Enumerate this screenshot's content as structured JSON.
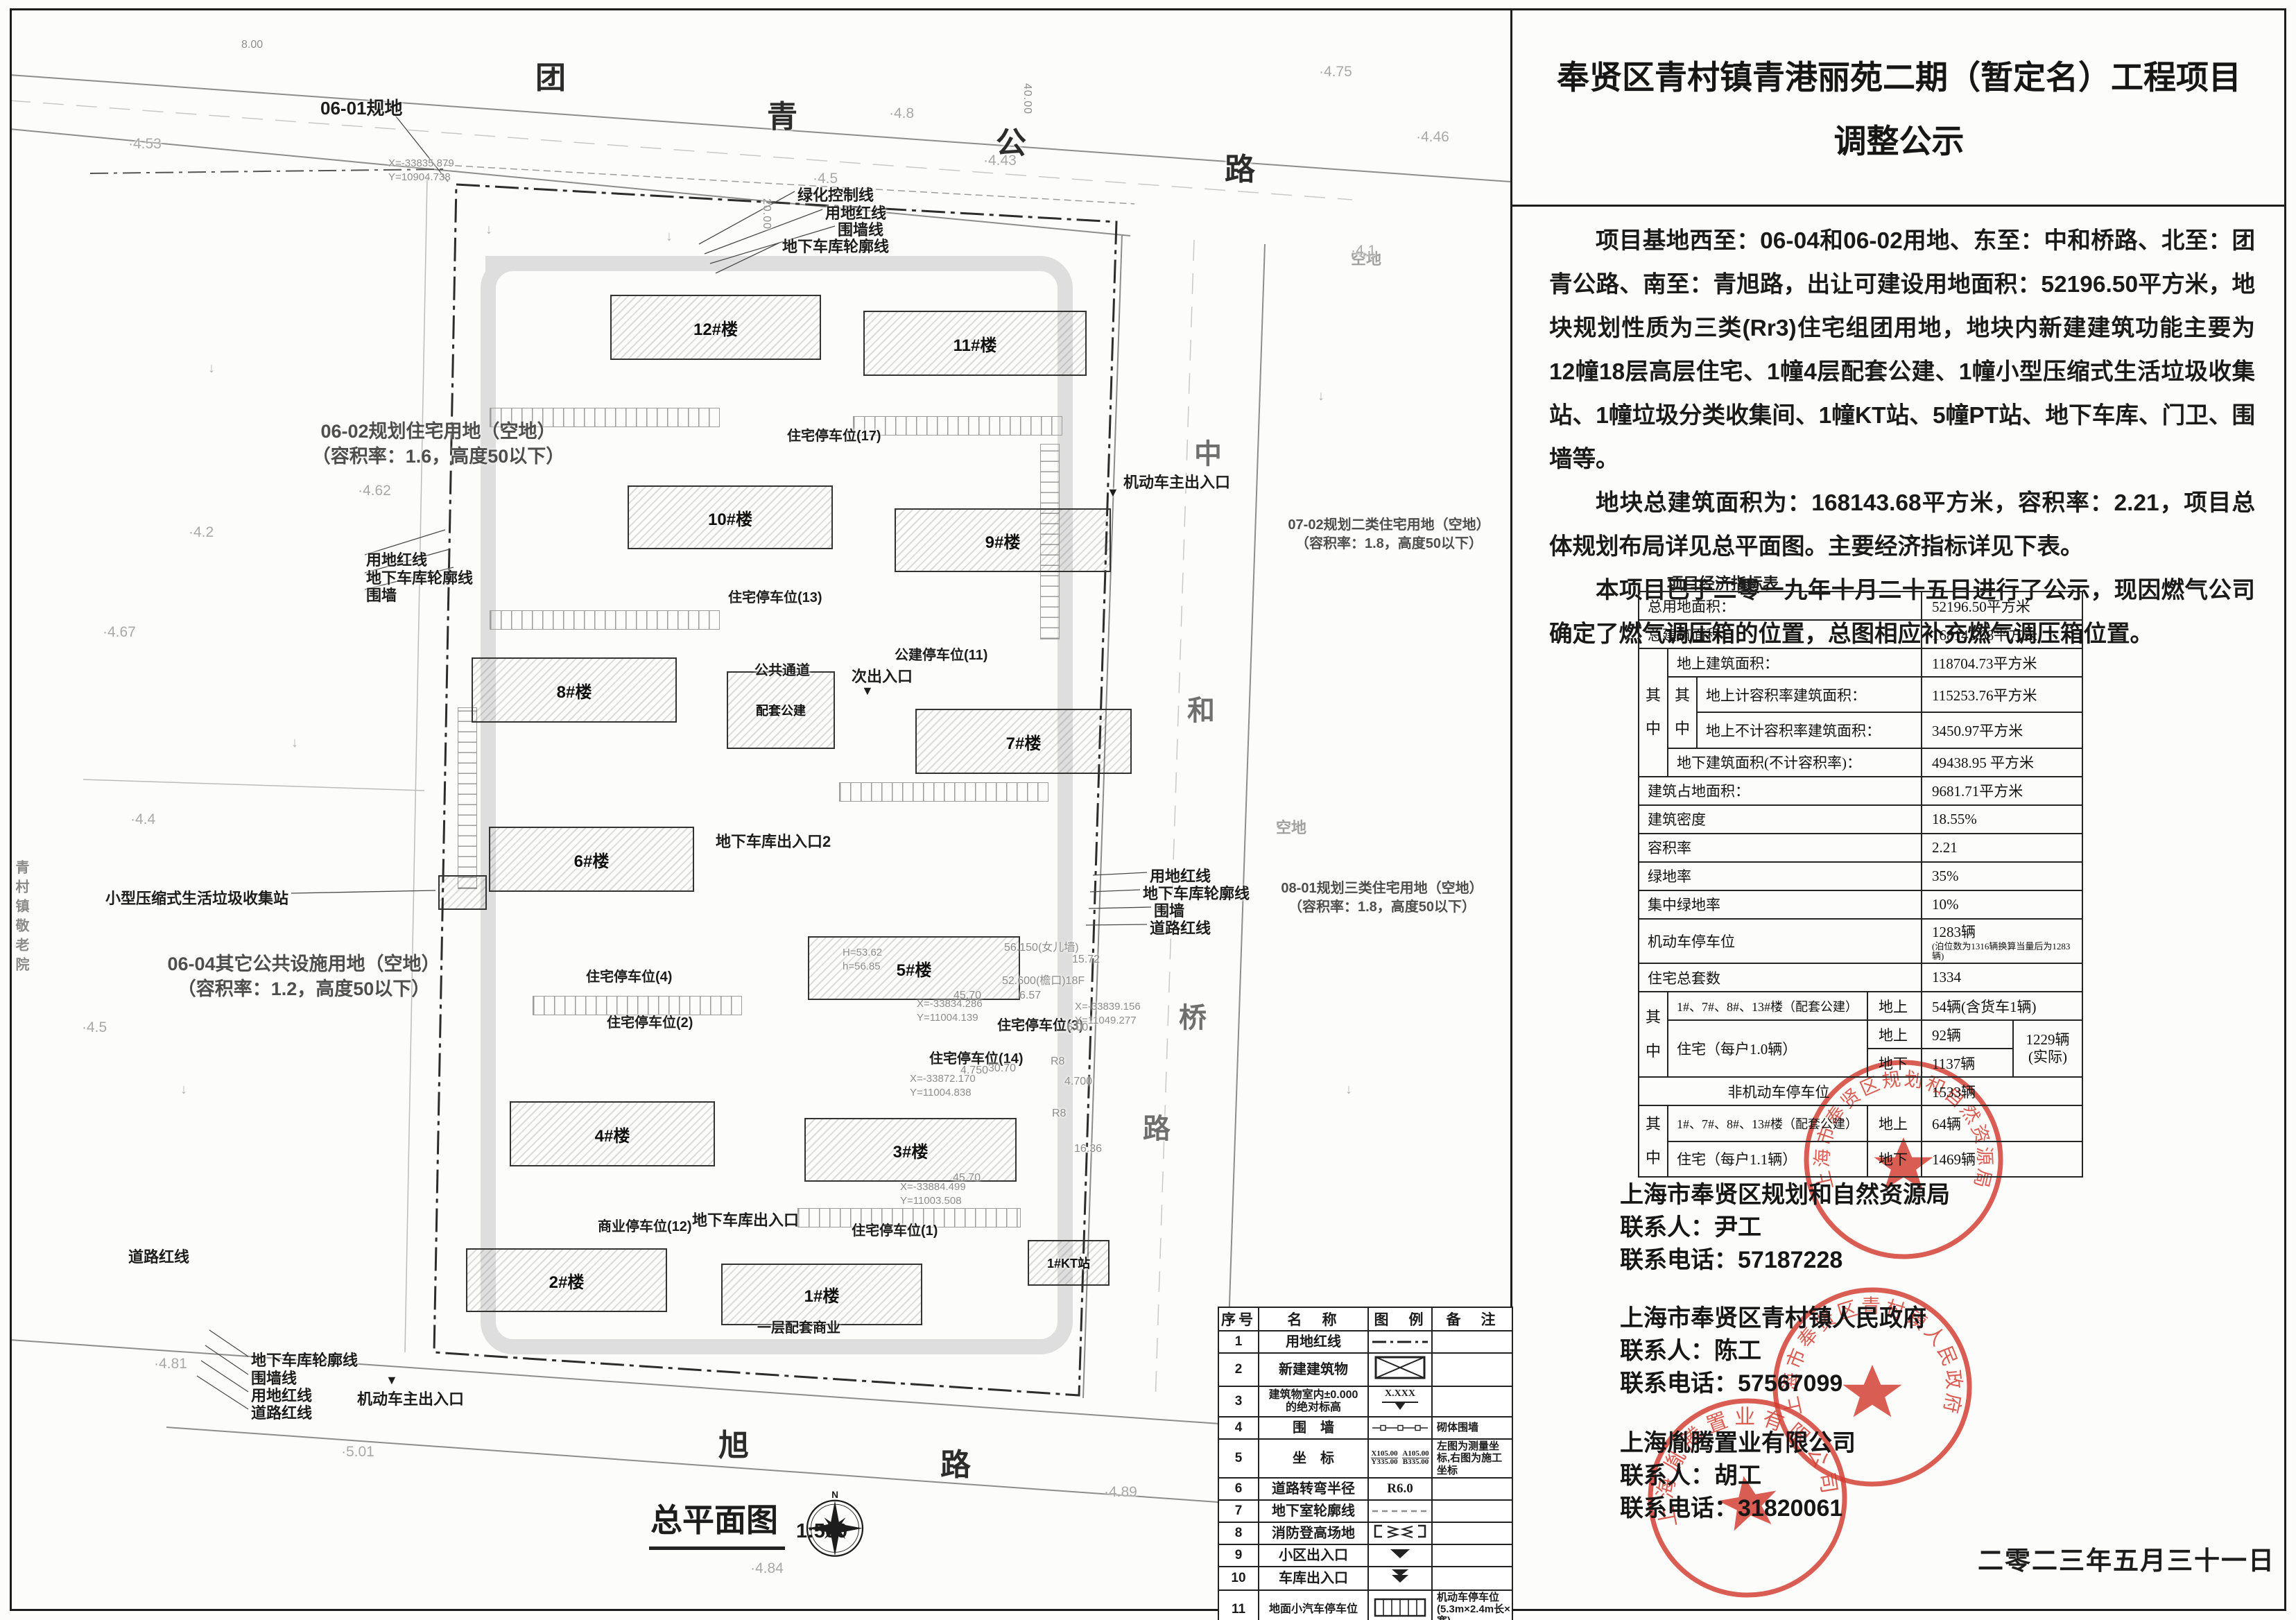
{
  "colors": {
    "ink": "#1c1c1c",
    "cad_gray": "#8d8d8d",
    "stamp_red": "#d23b2f"
  },
  "panel": {
    "title_line1": "奉贤区青村镇青港丽苑二期（暂定名）工程项目",
    "title_line2": "调整公示",
    "para1": "项目基地西至：06-04和06-02用地、东至：中和桥路、北至：团青公路、南至：青旭路，出让可建设用地面积：52196.50平方米，地块规划性质为三类(Rr3)住宅组团用地，地块内新建建筑功能主要为12幢18层高层住宅、1幢4层配套公建、1幢小型压缩式生活垃圾收集站、1幢垃圾分类收集间、1幢KT站、5幢PT站、地下车库、门卫、围墙等。",
    "para2": "地块总建筑面积为：168143.68平方米，容积率：2.21，项目总体规划布局详见总平面图。主要经济指标详见下表。",
    "para3": "本项目已于二零一九年十月二十五日进行了公示，现因燃气公司确定了燃气调压箱的位置，总图相应补充燃气调压箱位置。",
    "date": "二零二三年五月三十一日"
  },
  "econ": {
    "cap": "项目经济指标表",
    "band": "其\n中",
    "r1": {
      "l": "总用地面积：",
      "v": "52196.50平方米"
    },
    "r2": {
      "l": "总建筑面积：",
      "v": "168143.68平方米"
    },
    "r3": {
      "l": "地上建筑面积：",
      "v": "118704.73平方米"
    },
    "r4": {
      "l": "地上计容积率建筑面积：",
      "v": "115253.76平方米"
    },
    "r5": {
      "l": "地上不计容积率建筑面积：",
      "v": "3450.97平方米"
    },
    "r6": {
      "l": "地下建筑面积(不计容积率)：",
      "v": "49438.95 平方米"
    },
    "r7": {
      "l": "建筑占地面积：",
      "v": "9681.71平方米"
    },
    "r8": {
      "l": "建筑密度",
      "v": "18.55%"
    },
    "r9": {
      "l": "容积率",
      "v": "2.21"
    },
    "r10": {
      "l": "绿地率",
      "v": "35%"
    },
    "r11": {
      "l": "集中绿地率",
      "v": "10%"
    },
    "r12": {
      "l": "机动车停车位",
      "v": "1283辆",
      "n": "(泊位数为1316辆换算当量后为1283辆)"
    },
    "r13": {
      "l": "住宅总套数",
      "v": "1334"
    },
    "r14": {
      "l": "1#、7#、8#、13#楼（配套公建）",
      "s": "地上",
      "v": "54辆(含货车1辆)"
    },
    "r15": {
      "l": "住宅（每户1.0辆）",
      "s1": "地上",
      "v1": "92辆",
      "s2": "地下",
      "v2": "1137辆",
      "x": "1229辆\n(实际)"
    },
    "r16": {
      "l": "非机动车停车位",
      "v": "1533辆"
    },
    "r17": {
      "l": "1#、7#、8#、13#楼（配套公建）",
      "s": "地上",
      "v": "64辆"
    },
    "r18": {
      "l": "住宅（每户1.1辆）",
      "s": "地下",
      "v": "1469辆"
    }
  },
  "contacts": [
    {
      "org": "上海市奉贤区规划和自然资源局",
      "person": "联系人：尹工",
      "phone": "联系电话：57187228"
    },
    {
      "org": "上海市奉贤区青村镇人民政府",
      "person": "联系人：陈工",
      "phone": "联系电话：57567099"
    },
    {
      "org": "上海胤腾置业有限公司",
      "person": "联系人：胡工",
      "phone": "联系电话：31820061"
    }
  ],
  "stamps": [
    "上海市奉贤区规划和自然资源局",
    "上海市奉贤区青村镇人民政府",
    "上海胤腾置业有限公司"
  ],
  "legend": {
    "h": [
      "序号",
      "名　称",
      "图　例",
      "备　注"
    ],
    "rows": [
      {
        "n": "1",
        "t": "用地红线",
        "b": ""
      },
      {
        "n": "2",
        "t": "新建建筑物",
        "b": ""
      },
      {
        "n": "3",
        "t": "建筑物室内±0.000\n的绝对标高",
        "x": "X.XXX",
        "b": ""
      },
      {
        "n": "4",
        "t": "围　墙",
        "b": "砌体围墙"
      },
      {
        "n": "5",
        "t": "坐　标",
        "x1": "X105.00",
        "y1": "Y335.00",
        "x2": "A105.00",
        "y2": "B335.00",
        "b": "左图为测量坐标,右图为施工坐标"
      },
      {
        "n": "6",
        "t": "道路转弯半径",
        "x": "R6.0",
        "b": ""
      },
      {
        "n": "7",
        "t": "地下室轮廓线",
        "b": ""
      },
      {
        "n": "8",
        "t": "消防登高场地",
        "b": ""
      },
      {
        "n": "9",
        "t": "小区出入口",
        "b": ""
      },
      {
        "n": "10",
        "t": "车库出入口",
        "b": ""
      },
      {
        "n": "11",
        "t": "地面小汽车停车位",
        "b": "机动车停车位\n(5.3m×2.4m长×宽)"
      }
    ]
  },
  "plan": {
    "map_title": "总平面图",
    "map_scale": "1:500",
    "north": "N",
    "roads": {
      "top": [
        "团",
        "青",
        "公",
        "路"
      ],
      "east": [
        "中",
        "和",
        "桥",
        "路"
      ],
      "south": [
        "旭",
        "路"
      ],
      "west_side": "青村镇敬老院"
    },
    "block_tag": "06-01规地",
    "vacant": "空地",
    "parcels": [
      {
        "l1": "06-02规划住宅用地（空地）",
        "l2": "（容积率：1.6，高度50以下）"
      },
      {
        "l1": "06-04其它公共设施用地（空地）",
        "l2": "（容积率：1.2，高度50以下）"
      },
      {
        "l1": "07-02规划二类住宅用地（空地）",
        "l2": "（容积率：1.8，高度50以下）"
      },
      {
        "l1": "08-01规划三类住宅用地（空地）",
        "l2": "（容积率：1.8，高度50以下）"
      }
    ],
    "callouts": {
      "top": [
        "绿化控制线",
        "用地红线",
        "围墙线",
        "地下车库轮廓线"
      ],
      "left": [
        "用地红线",
        "地下车库轮廓线",
        "围墙"
      ],
      "right": [
        "用地红线",
        "地下车库轮廓线",
        "围墙",
        "道路红线"
      ],
      "bottom": [
        "地下车库轮廓线",
        "围墙线",
        "用地红线",
        "道路红线"
      ],
      "road_red": "道路红线",
      "waste": "小型压缩式生活垃圾收集站"
    },
    "entrances": {
      "main_top": "机动车主出入口",
      "secondary": "次出入口",
      "main_bottom": "机动车主出入口",
      "garage1": "地下车库出入口2",
      "garage2": "地下车库出入口"
    },
    "buildings": [
      {
        "label": "12#楼"
      },
      {
        "label": "11#楼"
      },
      {
        "label": "10#楼"
      },
      {
        "label": "9#楼"
      },
      {
        "label": "8#楼"
      },
      {
        "label": "7#楼"
      },
      {
        "label": "6#楼"
      },
      {
        "label": "5#楼"
      },
      {
        "label": "4#楼"
      },
      {
        "label": "3#楼"
      },
      {
        "label": "2#楼"
      },
      {
        "label": "1#楼"
      },
      {
        "label": "配套公建"
      },
      {
        "label": "1#KT站"
      }
    ],
    "parking": [
      "住宅停车位(17)",
      "住宅停车位(13)",
      "公建停车位(11)",
      "公共通道",
      "住宅停车位(14)",
      "住宅停车位(3)",
      "住宅停车位(4)",
      "住宅停车位(2)",
      "商业停车位(12)",
      "住宅停车位(1)",
      "一层配套商业"
    ],
    "coords": [
      "X=-33835.879\nY=10904.738",
      "X=-33834.286\nY=11004.139",
      "X=-33872.170\nY=11004.838",
      "X=-33839.156\nY=11049.277",
      "X=-33884.499\nY=11003.508"
    ],
    "notes": {
      "hnote": "H=53.62\nh=56.85",
      "roof1": "56.150(女儿墙)",
      "roof2": "52.600(檐口)18F"
    },
    "dims": [
      "45.70",
      "45.70",
      "30.70",
      "6.00",
      "16.36",
      "6.57",
      "R8",
      "R8",
      "4.750",
      "4.700",
      "40.00",
      "20.00",
      "15.72",
      "8.00"
    ],
    "elevations": [
      "·4.53",
      "·4.8",
      "·4.5",
      "·4.43",
      "·4.46",
      "·4.75",
      "·4.1",
      "·4.2",
      "·4.62",
      "·4.67",
      "·4.4",
      "·4.5",
      "·4.81",
      "·5.01",
      "·4.84",
      "·4.89"
    ]
  },
  "icons": {
    "entrance_marker": "▼",
    "cad_arrow": "↓"
  }
}
